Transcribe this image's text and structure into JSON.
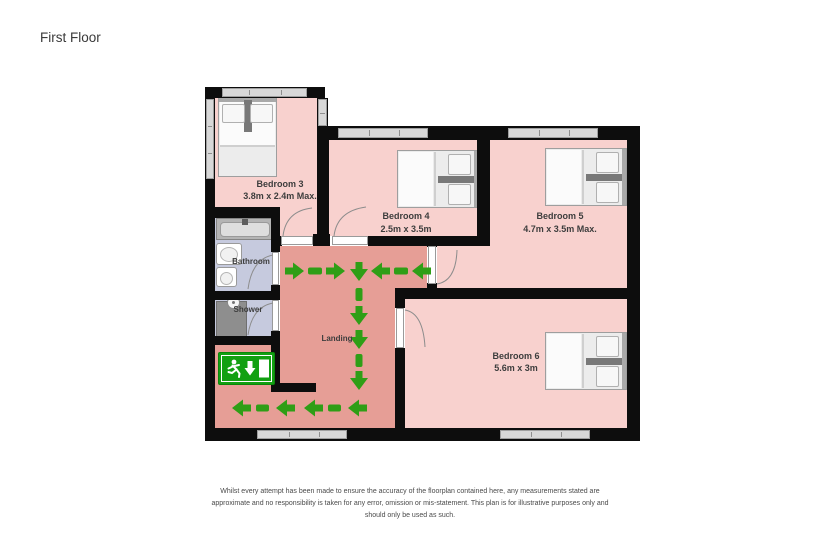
{
  "page": {
    "title": "First Floor"
  },
  "rooms": {
    "bedroom3": {
      "name": "Bedroom 3",
      "dims": "3.8m x 2.4m Max."
    },
    "bedroom4": {
      "name": "Bedroom 4",
      "dims": "2.5m x 3.5m"
    },
    "bedroom5": {
      "name": "Bedroom 5",
      "dims": "4.7m x 3.5m Max."
    },
    "bedroom6": {
      "name": "Bedroom 6",
      "dims": "5.6m x 3m"
    },
    "bathroom": {
      "name": "Bathroom"
    },
    "shower": {
      "name": "Shower"
    },
    "landing": {
      "name": "Landing"
    }
  },
  "colors": {
    "bedroom_floor": "#f8d1ce",
    "landing_floor": "#e69e96",
    "bathroom_floor": "#c6cade",
    "shower_tray": "#8e8e8e",
    "wall": "#0d0d0d",
    "window": "#d8d8d8",
    "route_arrow_green": "#2f9e16",
    "exit_sign_green": "#12a012"
  },
  "icons": [
    "fire-exit-sign",
    "running-man-icon",
    "down-arrow-icon",
    "exit-door-icon",
    "escape-route-arrows"
  ],
  "disclaimer": {
    "line1": "Whilst every attempt has been made to ensure the accuracy of the floorplan contained here, any measurements stated are",
    "line2": "approximate and no responsibility is taken for any error, omission or mis-statement. This plan is for illustrative purposes only and",
    "line3": "should only be used as such."
  }
}
